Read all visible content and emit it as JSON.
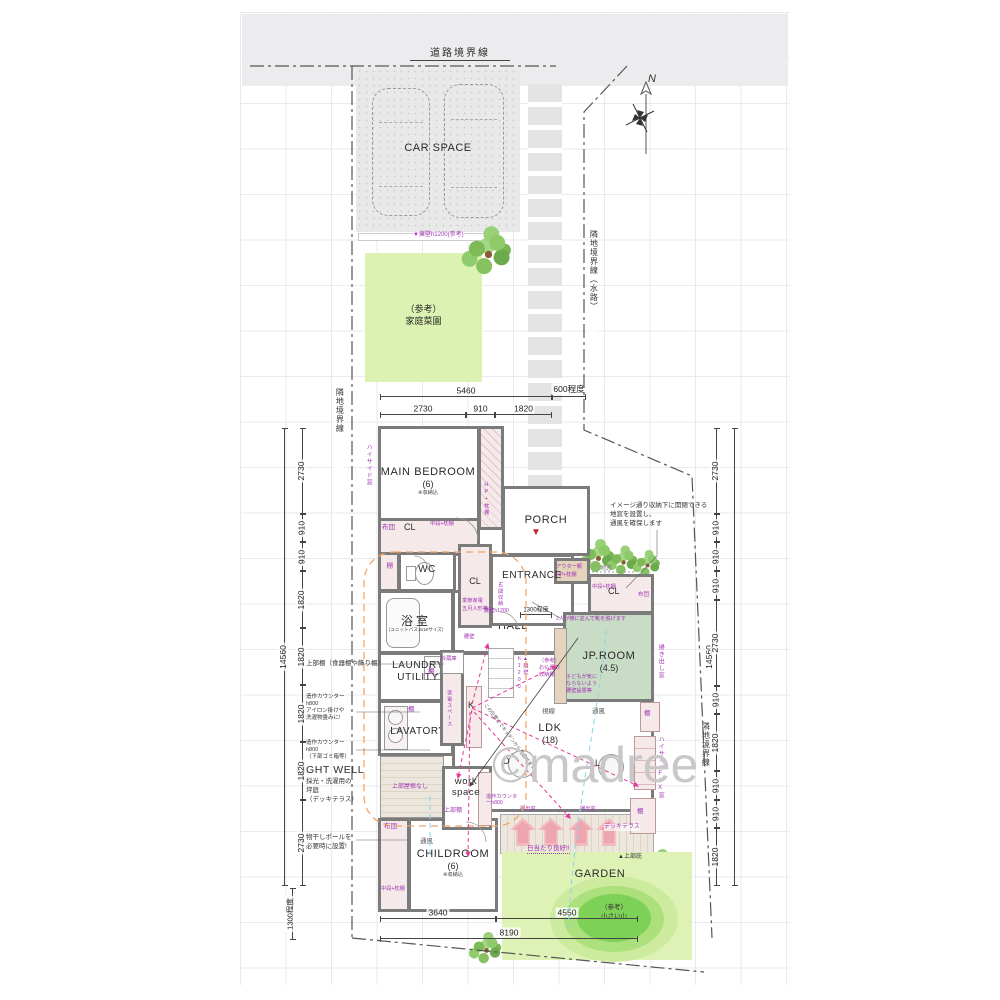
{
  "watermark": "©madree",
  "compass": {
    "n": "N"
  },
  "boundaries": {
    "road": "道路境界線",
    "left": "隣地境界線",
    "right_upper": "隣地境界線（水路）",
    "right_lower": "隣地境界線",
    "retaining": "▼擁壁h1200(参考)"
  },
  "site": {
    "car_space": "CAR SPACE",
    "garden_plot": {
      "l1": "（参考）",
      "l2": "家庭菜園"
    },
    "garden": "GARDEN",
    "hill": {
      "l1": "（参考）",
      "l2": "小さい山"
    },
    "deck_terrace": "デッキテラス",
    "sunny": "日当たり良好!!",
    "eave": "▲上部庇"
  },
  "rooms": {
    "main_bedroom": {
      "name": "MAIN BEDROOM",
      "size": "(6)",
      "note": "※収納込"
    },
    "porch": "PORCH",
    "entrance": "ENTRANCE",
    "wc": "WC",
    "bath": {
      "name": "浴室",
      "note": "（ユニットバス1616サイズ）"
    },
    "hall": "HALL",
    "laundry": {
      "l1": "LAUNDRY",
      "l2": "UTILITY"
    },
    "lavatory": "LAVATORY",
    "jp_room": {
      "name": "JP.ROOM",
      "size": "(4.5)"
    },
    "ldk": {
      "name": "LDK",
      "size": "(18)"
    },
    "work_space": {
      "l1": "work",
      "l2": "space"
    },
    "childroom": {
      "name": "CHILDROOM",
      "size": "(6)",
      "note": "※収納込"
    },
    "light_well": {
      "name": "LIGHT WELL",
      "n1": "採光・洗濯用の",
      "n2": "坪庭",
      "n3": "（デッキテラス）"
    }
  },
  "storage": {
    "cl": "CL",
    "futon": "布団",
    "chudan": "中段+枕棚",
    "hp_makura": "HP+枕棚",
    "tana": "棚",
    "genkan": "玄関収納",
    "outer": "アウター類",
    "kisetsu": "季節家電",
    "gogatsu": "五月人形等",
    "jobu_tana": "上部棚",
    "butsudan": {
      "l1": "（参考）",
      "l2": "お仏壇の",
      "l3": "収納棚"
    }
  },
  "marks": {
    "k": "K",
    "d": "D",
    "l": "L",
    "jimado": "地窓",
    "tsufu": "通風",
    "shisen": "視線",
    "koshikabe": "腰壁",
    "koshikabe_h": "腰壁h1200",
    "koshikabe_v": "▲腰壁h1200",
    "hakidashi": "掃出窓",
    "hakidashi_v": "掃き出し窓",
    "highside_fix": "ハイサイドFIX窓",
    "highside": "ハイサイド窓",
    "reizoko": "冷蔵庫",
    "kaden": "家電スペース",
    "yane_nashi": "上部屋根なし",
    "counter_ws": "造作カウンターh800",
    "step": "1300程度"
  },
  "notes": {
    "jimado_note": {
      "l1": "イメージ通り収納下に開閉できる",
      "l2": "地窓を設置し、",
      "l3": "通風を確保します"
    },
    "shoes": "2人が横に並んで靴を脱げます",
    "shelf_left": "上部棚（食器棚や飾り棚）",
    "counter1": {
      "l1": "造作カウンター",
      "l2": "h800",
      "l3": "アイロン掛けや",
      "l4": "洗濯物畳みに!"
    },
    "counter2": {
      "l1": "造作カウンター",
      "l2": "h800",
      "l3": "（下部ゴミ箱等）"
    },
    "pole": {
      "l1": "物干しポールを",
      "l2": "必要時に設置!"
    },
    "sightline": "この位置までキッチンから見渡せます",
    "jp_kids": {
      "l1": "子どもが気に",
      "l2": "ならないよう",
      "l3": "腰壁設置等"
    }
  },
  "dims": {
    "top": [
      "5460",
      "600程度"
    ],
    "top2": [
      "2730",
      "910",
      "1820"
    ],
    "left": [
      "2730",
      "910",
      "910",
      "1820",
      "1820",
      "1820",
      "1820",
      "2730"
    ],
    "left_total": "14560",
    "left_bottom": "1300程度",
    "right": [
      "2730",
      "910",
      "910",
      "910",
      "2730",
      "910",
      "1820",
      "910",
      "910",
      "1820"
    ],
    "right_total": "14560",
    "bottom": [
      "3640",
      "4550"
    ],
    "bottom_total": "8190"
  }
}
